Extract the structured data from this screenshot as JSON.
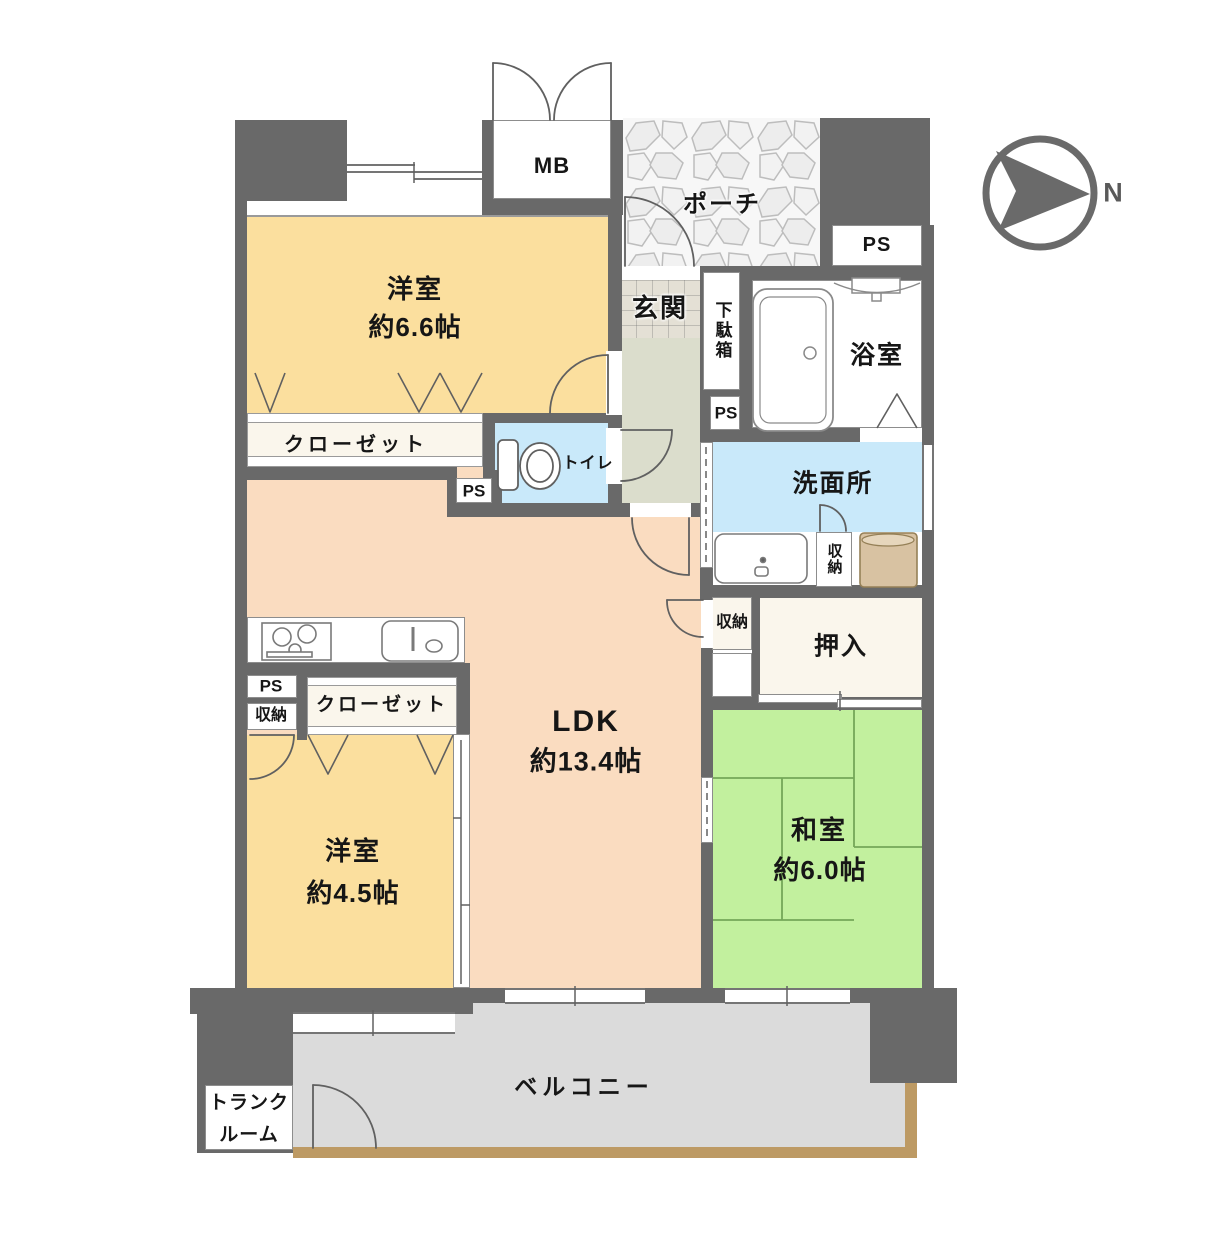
{
  "labels": {
    "mb": "MB",
    "porch": "ポーチ",
    "ps_upper": "PS",
    "genkan": "玄関",
    "getabako": "下駄箱",
    "bathroom": "浴室",
    "ps_entrance": "PS",
    "western1_name": "洋室",
    "western1_size": "約6.6帖",
    "closet1": "クローゼット",
    "ps_toilet": "PS",
    "toilet": "トイレ",
    "washroom": "洗面所",
    "storage_washroom": "収納",
    "storage_hall": "収納",
    "oshiire": "押入",
    "ps_kitchen": "PS",
    "storage_kitchen": "収納",
    "closet2": "クローゼット",
    "ldk_name": "LDK",
    "ldk_size": "約13.4帖",
    "western2_name": "洋室",
    "western2_size": "約4.5帖",
    "japanese_name": "和室",
    "japanese_size": "約6.0帖",
    "balcony": "ベルコニー",
    "trunk_line1": "トランク",
    "trunk_line2": "ルーム",
    "north": "N"
  },
  "colors": {
    "wall": "#696969",
    "western_room": "#FBDF9E",
    "ldk": "#FADCC0",
    "japanese_room": "#C2F09E",
    "tatami_line": "#74A758",
    "water_blue": "#C9E9FA",
    "hall": "#DBDDCC",
    "closet_cream": "#FAF6EC",
    "balcony_gray": "#DBDBDB",
    "balcony_edge": "#BD9A64",
    "washer_tan": "#D8C2A2"
  }
}
